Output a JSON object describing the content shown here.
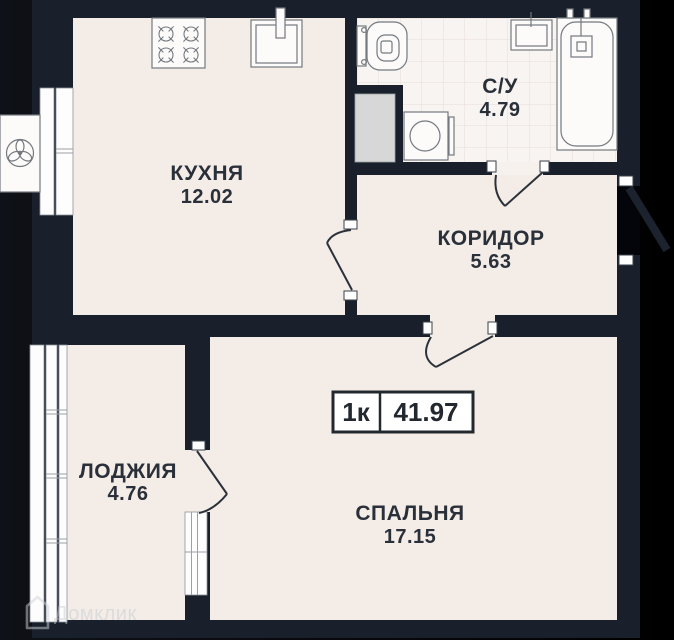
{
  "plan": {
    "type_badge": {
      "rooms": "1к",
      "total_area": "41.97"
    },
    "rooms": [
      {
        "id": "kitchen",
        "name": "КУХНЯ",
        "area": "12.02"
      },
      {
        "id": "bathroom",
        "name": "С/У",
        "area": "4.79"
      },
      {
        "id": "corridor",
        "name": "КОРИДОР",
        "area": "5.63"
      },
      {
        "id": "loggia",
        "name": "ЛОДЖИЯ",
        "area": "4.76"
      },
      {
        "id": "bedroom",
        "name": "СПАЛЬНЯ",
        "area": "17.15"
      }
    ]
  },
  "watermark": {
    "label": "Домклик"
  },
  "colors": {
    "background": "#000000",
    "wall": "#1a202b",
    "floor": "#f4ede7",
    "tile_floor": "#f8f4f1",
    "tile_grid": "#e8ddd6",
    "shaft": "#d6d7d6",
    "text": "#2a303a",
    "badge_border": "#23282f",
    "watermark": "#c6cbd1"
  }
}
